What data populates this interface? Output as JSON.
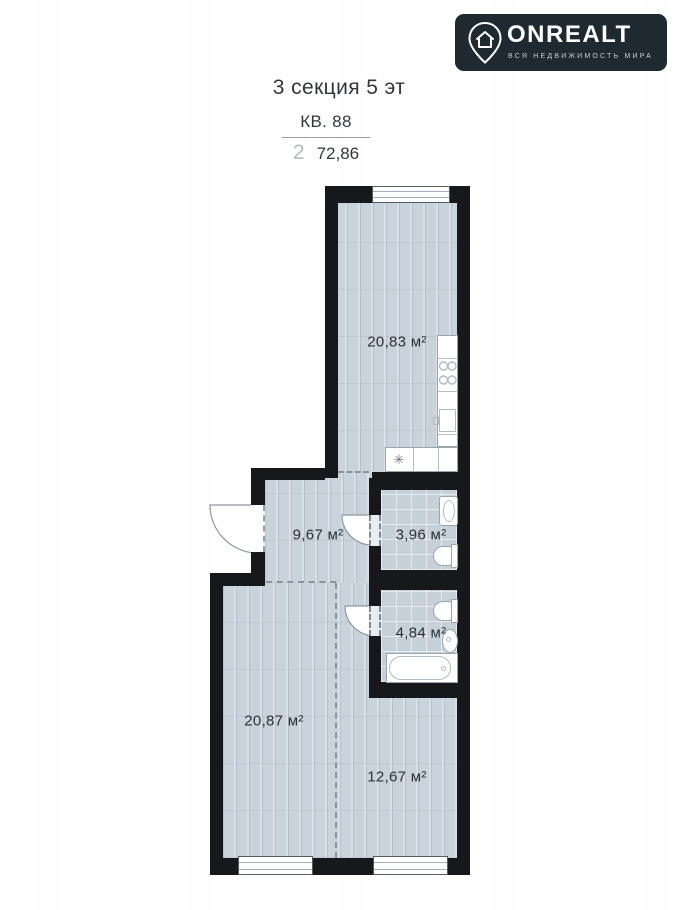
{
  "logo": {
    "brand": "ONREALT",
    "tagline": "ВСЯ НЕДВИЖИМОСТЬ МИРА"
  },
  "header": {
    "title": "3 секция 5 эт",
    "apartment": "КВ. 88",
    "room_count": "2",
    "total_area": "72,86"
  },
  "plan": {
    "rooms": [
      {
        "name": "kitchen-living",
        "area": "20,83 м²"
      },
      {
        "name": "hallway",
        "area": "9,67 м²"
      },
      {
        "name": "bathroom-small",
        "area": "3,96 м²"
      },
      {
        "name": "bathroom-large",
        "area": "4,84 м²"
      },
      {
        "name": "room-left",
        "area": "20,87 м²"
      },
      {
        "name": "room-right",
        "area": "12,67 м²"
      }
    ],
    "fridge_symbol": "✳"
  },
  "colors": {
    "wall": "#17181b",
    "floor_plank": "#c9d3dc",
    "floor_tile": "#c6d0d9",
    "badge_background": "#1f2930",
    "text": "#33373c"
  }
}
